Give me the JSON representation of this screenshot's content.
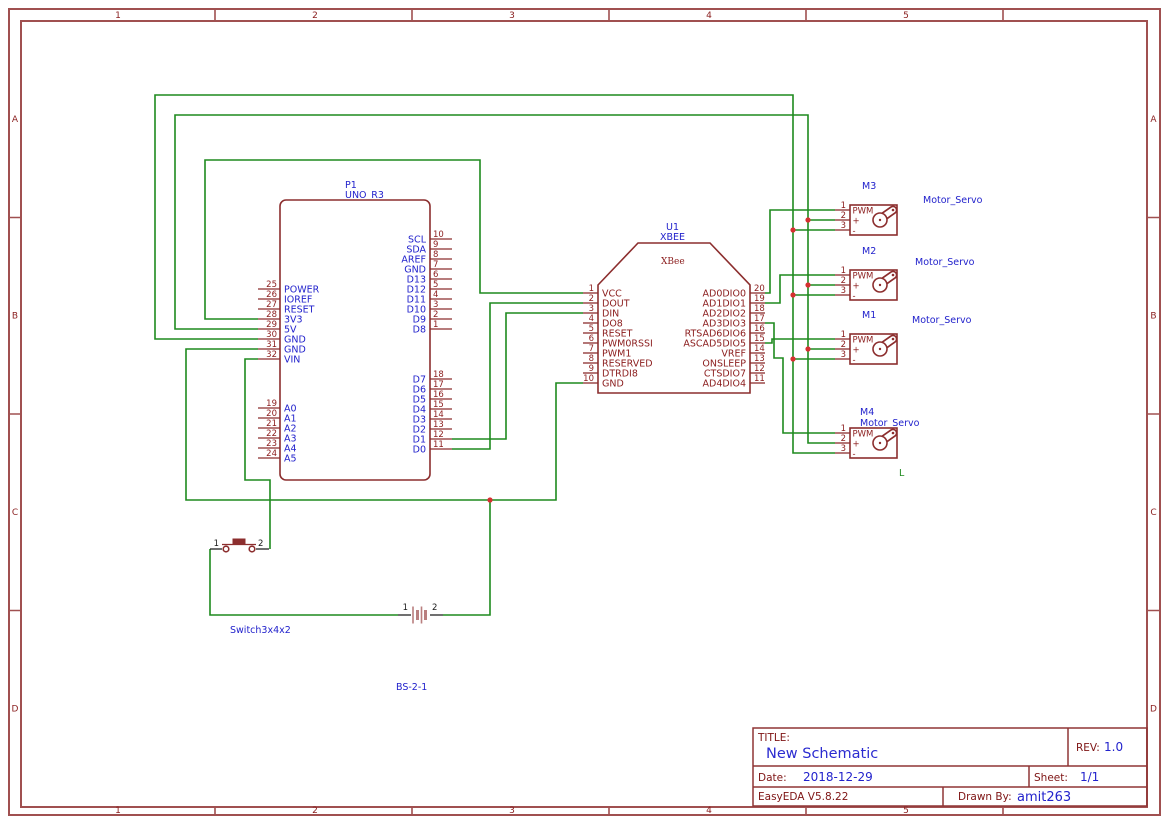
{
  "colors": {
    "wire_green": "#1E8A1E",
    "component_outline": "#8C2E2E",
    "label_blue": "#2222CC",
    "pin_number_red": "#8B1D1D",
    "junction_red": "#D63030",
    "border_red": "#A05050",
    "battery_rose": "#B97F7F"
  },
  "border": {
    "cols": [
      "1",
      "2",
      "3",
      "4",
      "5"
    ],
    "rows": [
      "A",
      "B",
      "C",
      "D"
    ]
  },
  "title_block": {
    "title_label": "TITLE:",
    "title": "New Schematic",
    "rev_label": "REV:",
    "rev": "1.0",
    "date_label": "Date:",
    "date": "2018-12-29",
    "sheet_label": "Sheet:",
    "sheet": "1/1",
    "software": "EasyEDA V5.8.22",
    "drawn_by_label": "Drawn By:",
    "drawn_by": "amit263"
  },
  "uno": {
    "ref": "P1",
    "part": "UNO_R3",
    "left_top": [
      {
        "num": "25",
        "name": "POWER"
      },
      {
        "num": "26",
        "name": "IOREF"
      },
      {
        "num": "27",
        "name": "RESET"
      },
      {
        "num": "28",
        "name": "3V3"
      },
      {
        "num": "29",
        "name": "5V"
      },
      {
        "num": "30",
        "name": "GND"
      },
      {
        "num": "31",
        "name": "GND"
      },
      {
        "num": "32",
        "name": "VIN"
      }
    ],
    "left_bottom": [
      {
        "num": "19",
        "name": "A0"
      },
      {
        "num": "20",
        "name": "A1"
      },
      {
        "num": "21",
        "name": "A2"
      },
      {
        "num": "22",
        "name": "A3"
      },
      {
        "num": "23",
        "name": "A4"
      },
      {
        "num": "24",
        "name": "A5"
      }
    ],
    "right_top": [
      {
        "num": "10",
        "name": "SCL"
      },
      {
        "num": "9",
        "name": "SDA"
      },
      {
        "num": "8",
        "name": "AREF"
      },
      {
        "num": "7",
        "name": "GND"
      },
      {
        "num": "6",
        "name": "D13"
      },
      {
        "num": "5",
        "name": "D12"
      },
      {
        "num": "4",
        "name": "D11"
      },
      {
        "num": "3",
        "name": "D10"
      },
      {
        "num": "2",
        "name": "D9"
      },
      {
        "num": "1",
        "name": "D8"
      }
    ],
    "right_bottom": [
      {
        "num": "18",
        "name": "D7"
      },
      {
        "num": "17",
        "name": "D6"
      },
      {
        "num": "16",
        "name": "D5"
      },
      {
        "num": "15",
        "name": "D4"
      },
      {
        "num": "14",
        "name": "D3"
      },
      {
        "num": "13",
        "name": "D2"
      },
      {
        "num": "12",
        "name": "D1"
      },
      {
        "num": "11",
        "name": "D0"
      }
    ]
  },
  "xbee": {
    "ref": "U1",
    "part": "XBEE",
    "inner_label": "XBee",
    "left": [
      {
        "num": "1",
        "name": "VCC"
      },
      {
        "num": "2",
        "name": "DOUT"
      },
      {
        "num": "3",
        "name": "DIN"
      },
      {
        "num": "4",
        "name": "DO8"
      },
      {
        "num": "5",
        "name": "RESET"
      },
      {
        "num": "6",
        "name": "PWM0RSSI"
      },
      {
        "num": "7",
        "name": "PWM1"
      },
      {
        "num": "8",
        "name": "RESERVED"
      },
      {
        "num": "9",
        "name": "DTRDI8"
      },
      {
        "num": "10",
        "name": "GND"
      }
    ],
    "right": [
      {
        "num": "20",
        "name": "AD0DIO0"
      },
      {
        "num": "19",
        "name": "AD1DIO1"
      },
      {
        "num": "18",
        "name": "AD2DIO2"
      },
      {
        "num": "17",
        "name": "AD3DIO3"
      },
      {
        "num": "16",
        "name": "RTSAD6DIO6"
      },
      {
        "num": "15",
        "name": "ASCAD5DIO5"
      },
      {
        "num": "14",
        "name": "VREF"
      },
      {
        "num": "13",
        "name": "ONSLEEP"
      },
      {
        "num": "12",
        "name": "CTSDIO7"
      },
      {
        "num": "11",
        "name": "AD4DIO4"
      }
    ]
  },
  "servo_pins": [
    {
      "num": "1",
      "name": "PWM"
    },
    {
      "num": "2",
      "name": "+"
    },
    {
      "num": "3",
      "name": "-"
    }
  ],
  "servos": [
    {
      "ref": "M3",
      "part": "Motor_Servo"
    },
    {
      "ref": "M2",
      "part": "Motor_Servo"
    },
    {
      "ref": "M1",
      "part": "Motor_Servo"
    },
    {
      "ref": "M4",
      "part": "Motor_Servo"
    }
  ],
  "switch": {
    "label": "Switch3x4x2",
    "pin1": "1",
    "pin2": "2"
  },
  "battery": {
    "label": "BS-2-1",
    "pin1": "1",
    "pin2": "2"
  },
  "net_label": "L"
}
